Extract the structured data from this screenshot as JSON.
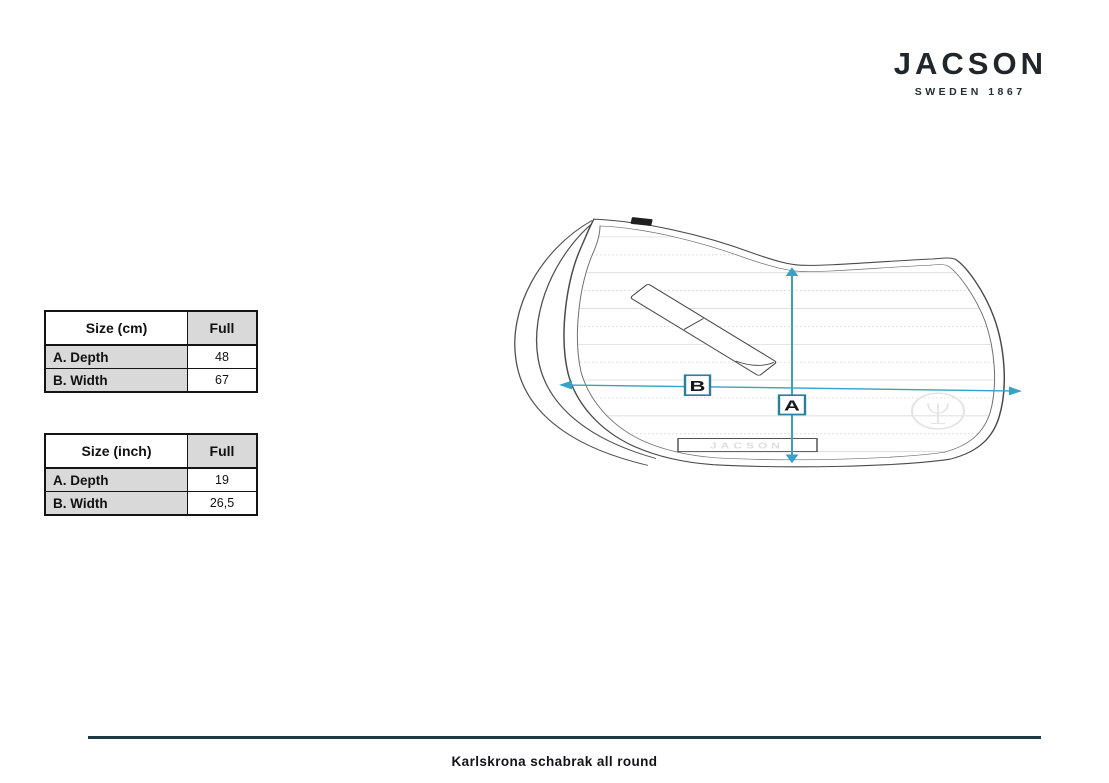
{
  "brand": {
    "name": "JACSON",
    "tagline": "SWEDEN 1867"
  },
  "size_tables": [
    {
      "headers": [
        "Size (cm)",
        "Full"
      ],
      "rows": [
        {
          "label": "A. Depth",
          "value": "48"
        },
        {
          "label": "B. Width",
          "value": "67"
        }
      ]
    },
    {
      "headers": [
        "Size (inch)",
        "Full"
      ],
      "rows": [
        {
          "label": "A. Depth",
          "value": "19"
        },
        {
          "label": "B. Width",
          "value": "26,5"
        }
      ]
    }
  ],
  "diagram": {
    "depth_label": "A",
    "width_label": "B",
    "watermark_text": "JACSON",
    "arrow_color": "#35a2c6",
    "label_box_border": "#2b7f99"
  },
  "footer": {
    "caption": "Karlskrona schabrak all round",
    "divider_color": "#1d3b46"
  }
}
